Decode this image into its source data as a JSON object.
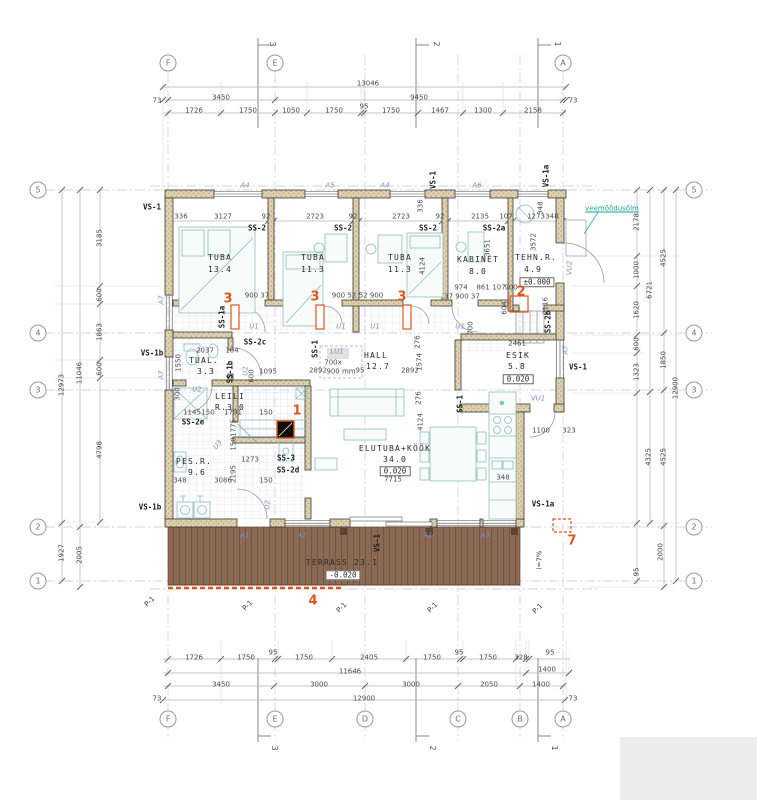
{
  "drawing": {
    "type": "floor-plan",
    "rooms": [
      {
        "name": "TUBA",
        "area_m2": "13.4"
      },
      {
        "name": "TUBA",
        "area_m2": "11.3"
      },
      {
        "name": "TUBA",
        "area_m2": "11.3"
      },
      {
        "name": "KABINET",
        "area_m2": "8.0"
      },
      {
        "name": "TEHN.R.",
        "area_m2": "4.9",
        "level": "±0.000"
      },
      {
        "name": "TUAL.",
        "area_m2": "3.3"
      },
      {
        "name": "HALL",
        "area_m2": "12.7"
      },
      {
        "name": "ESIK",
        "area_m2": "5.8",
        "level": "0.020"
      },
      {
        "name": "LEILI R.",
        "area_m2": "3.0"
      },
      {
        "name": "PES.R.",
        "area_m2": "9.6"
      },
      {
        "name": "ELUTUBA+KÖÖK",
        "area_m2": "34.0",
        "level": "0.020"
      },
      {
        "name": "TERRASS",
        "area_m2": "23.1",
        "level": "-0.020"
      }
    ],
    "colors": {
      "marker_orange": "#e0551c",
      "terrace_brown": "#8b6a55",
      "wall_fill": "#ded0ae",
      "blue_label": "#7d8fc4",
      "teal_note": "#17a2a2"
    }
  },
  "grid": {
    "letters_top": [
      "F",
      "E",
      "A"
    ],
    "letters_bottom": [
      "F",
      "E",
      "D",
      "C",
      "B",
      "A"
    ],
    "numbers_left": [
      "5",
      "4",
      "3",
      "2",
      "1"
    ],
    "numbers_right": [
      "5",
      "4",
      "3",
      "2",
      "1"
    ],
    "circles": [
      {
        "t": "F",
        "x": 168,
        "y": 63
      },
      {
        "t": "E",
        "x": 275,
        "y": 63
      },
      {
        "t": "A",
        "x": 563,
        "y": 63
      },
      {
        "t": "F",
        "x": 168,
        "y": 719
      },
      {
        "t": "E",
        "x": 275,
        "y": 719
      },
      {
        "t": "D",
        "x": 365,
        "y": 719
      },
      {
        "t": "C",
        "x": 458,
        "y": 719
      },
      {
        "t": "B",
        "x": 520,
        "y": 719
      },
      {
        "t": "A",
        "x": 563,
        "y": 719
      },
      {
        "t": "5",
        "x": 38,
        "y": 190
      },
      {
        "t": "4",
        "x": 38,
        "y": 333
      },
      {
        "t": "3",
        "x": 38,
        "y": 390
      },
      {
        "t": "2",
        "x": 38,
        "y": 527
      },
      {
        "t": "1",
        "x": 38,
        "y": 581
      },
      {
        "t": "5",
        "x": 694,
        "y": 190
      },
      {
        "t": "4",
        "x": 694,
        "y": 333
      },
      {
        "t": "3",
        "x": 694,
        "y": 390
      },
      {
        "t": "2",
        "x": 694,
        "y": 527
      },
      {
        "t": "1",
        "x": 694,
        "y": 581
      }
    ]
  },
  "texts": [
    {
      "t": "13046",
      "x": 368,
      "y": 84
    },
    {
      "t": "73",
      "x": 157,
      "y": 101
    },
    {
      "t": "3450",
      "x": 221,
      "y": 98
    },
    {
      "t": "9450",
      "x": 419,
      "y": 98
    },
    {
      "t": "73",
      "x": 573,
      "y": 101
    },
    {
      "t": "1726",
      "x": 194,
      "y": 111
    },
    {
      "t": "1750",
      "x": 248,
      "y": 111
    },
    {
      "t": "1050",
      "x": 291,
      "y": 111
    },
    {
      "t": "1750",
      "x": 334,
      "y": 111
    },
    {
      "t": "95",
      "x": 364,
      "y": 107
    },
    {
      "t": "1750",
      "x": 391,
      "y": 111
    },
    {
      "t": "1467",
      "x": 440,
      "y": 111
    },
    {
      "t": "1300",
      "x": 483,
      "y": 111
    },
    {
      "t": "2158",
      "x": 533,
      "y": 111
    },
    {
      "t": "1726",
      "x": 194,
      "y": 658
    },
    {
      "t": "1750",
      "x": 246,
      "y": 658
    },
    {
      "t": "95",
      "x": 273,
      "y": 653
    },
    {
      "t": "1750",
      "x": 304,
      "y": 658
    },
    {
      "t": "2405",
      "x": 369,
      "y": 658
    },
    {
      "t": "1750",
      "x": 432,
      "y": 658
    },
    {
      "t": "95",
      "x": 459,
      "y": 653
    },
    {
      "t": "1750",
      "x": 488,
      "y": 658
    },
    {
      "t": "328",
      "x": 521,
      "y": 658
    },
    {
      "t": "95",
      "x": 550,
      "y": 653
    },
    {
      "t": "11646",
      "x": 350,
      "y": 672
    },
    {
      "t": "1400",
      "x": 547,
      "y": 670
    },
    {
      "t": "3450",
      "x": 221,
      "y": 685
    },
    {
      "t": "3000",
      "x": 319,
      "y": 685
    },
    {
      "t": "3000",
      "x": 411,
      "y": 685
    },
    {
      "t": "2050",
      "x": 489,
      "y": 685
    },
    {
      "t": "1400",
      "x": 541,
      "y": 685
    },
    {
      "t": "73",
      "x": 157,
      "y": 699
    },
    {
      "t": "12900",
      "x": 364,
      "y": 699
    },
    {
      "t": "73",
      "x": 573,
      "y": 699
    },
    {
      "t": "12973",
      "x": 62,
      "y": 385,
      "r": -90
    },
    {
      "t": "1927",
      "x": 62,
      "y": 553,
      "r": -90
    },
    {
      "t": "11046",
      "x": 80,
      "y": 373,
      "r": -90
    },
    {
      "t": "2005",
      "x": 80,
      "y": 555,
      "r": -90
    },
    {
      "t": "3185",
      "x": 100,
      "y": 238,
      "r": -90
    },
    {
      "t": "600",
      "x": 100,
      "y": 295,
      "r": -90
    },
    {
      "t": "1863",
      "x": 100,
      "y": 332,
      "r": -90
    },
    {
      "t": "600",
      "x": 100,
      "y": 369,
      "r": -90
    },
    {
      "t": "4798",
      "x": 100,
      "y": 450,
      "r": -90
    },
    {
      "t": "2178",
      "x": 637,
      "y": 222,
      "r": -90
    },
    {
      "t": "1000",
      "x": 637,
      "y": 270,
      "r": -90
    },
    {
      "t": "1620",
      "x": 637,
      "y": 310,
      "r": -90
    },
    {
      "t": "600",
      "x": 637,
      "y": 344,
      "r": -90
    },
    {
      "t": "1323",
      "x": 637,
      "y": 372,
      "r": -90
    },
    {
      "t": "95",
      "x": 637,
      "y": 572,
      "r": -90
    },
    {
      "t": "6721",
      "x": 650,
      "y": 290,
      "r": -90
    },
    {
      "t": "4325",
      "x": 649,
      "y": 457,
      "r": -90
    },
    {
      "t": "4525",
      "x": 664,
      "y": 258,
      "r": -90
    },
    {
      "t": "1850",
      "x": 664,
      "y": 360,
      "r": -90
    },
    {
      "t": "4525",
      "x": 664,
      "y": 457,
      "r": -90
    },
    {
      "t": "2000",
      "x": 661,
      "y": 552,
      "r": -90
    },
    {
      "t": "12900",
      "x": 676,
      "y": 388,
      "r": -90
    },
    {
      "t": "336",
      "x": 181,
      "y": 217
    },
    {
      "t": "3127",
      "x": 223,
      "y": 217
    },
    {
      "t": "92",
      "x": 266,
      "y": 217
    },
    {
      "t": "2723",
      "x": 315,
      "y": 217
    },
    {
      "t": "92",
      "x": 353,
      "y": 217
    },
    {
      "t": "2723",
      "x": 401,
      "y": 217
    },
    {
      "t": "92",
      "x": 440,
      "y": 217
    },
    {
      "t": "2135",
      "x": 480,
      "y": 217
    },
    {
      "t": "107",
      "x": 506,
      "y": 217
    },
    {
      "t": "1273",
      "x": 536,
      "y": 217
    },
    {
      "t": "348",
      "x": 552,
      "y": 217
    },
    {
      "t": "336",
      "x": 421,
      "y": 206,
      "r": -90
    },
    {
      "t": "348",
      "x": 541,
      "y": 208,
      "r": -90
    },
    {
      "t": "3651",
      "x": 488,
      "y": 248,
      "r": -90
    },
    {
      "t": "3572",
      "x": 534,
      "y": 242,
      "r": -90
    },
    {
      "t": "4124",
      "x": 423,
      "y": 266,
      "r": -90
    },
    {
      "t": "900 37",
      "x": 257,
      "y": 296
    },
    {
      "t": "900 52",
      "x": 344,
      "y": 296
    },
    {
      "t": "52 900",
      "x": 371,
      "y": 296
    },
    {
      "t": "974",
      "x": 461,
      "y": 288
    },
    {
      "t": "861",
      "x": 483,
      "y": 288
    },
    {
      "t": "107",
      "x": 499,
      "y": 288
    },
    {
      "t": "900",
      "x": 511,
      "y": 288
    },
    {
      "t": "37 900 37",
      "x": 462,
      "y": 297
    },
    {
      "t": "700",
      "x": 471,
      "y": 328,
      "r": -90
    },
    {
      "t": "604",
      "x": 505,
      "y": 308,
      "r": -90
    },
    {
      "t": "2116",
      "x": 546,
      "y": 306,
      "r": -90
    },
    {
      "t": "2037",
      "x": 205,
      "y": 351
    },
    {
      "t": "104",
      "x": 232,
      "y": 351
    },
    {
      "t": "1550",
      "x": 179,
      "y": 363,
      "r": -90
    },
    {
      "t": "600",
      "x": 252,
      "y": 376,
      "r": -90
    },
    {
      "t": "1095",
      "x": 268,
      "y": 372
    },
    {
      "t": "2892",
      "x": 318,
      "y": 371
    },
    {
      "t": "95",
      "x": 360,
      "y": 371
    },
    {
      "t": "2892",
      "x": 410,
      "y": 371
    },
    {
      "t": "2461",
      "x": 517,
      "y": 344
    },
    {
      "t": "276",
      "x": 418,
      "y": 342,
      "r": -90
    },
    {
      "t": "1574",
      "x": 420,
      "y": 362,
      "r": -90
    },
    {
      "t": "276",
      "x": 419,
      "y": 398,
      "r": -90
    },
    {
      "t": "4124",
      "x": 421,
      "y": 422,
      "r": -90
    },
    {
      "t": "1100",
      "x": 541,
      "y": 431
    },
    {
      "t": "323",
      "x": 569,
      "y": 431
    },
    {
      "t": "300",
      "x": 178,
      "y": 394,
      "r": -90
    },
    {
      "t": "1145",
      "x": 192,
      "y": 413
    },
    {
      "t": "150",
      "x": 208,
      "y": 413
    },
    {
      "t": "1791",
      "x": 233,
      "y": 413
    },
    {
      "t": "150",
      "x": 266,
      "y": 413
    },
    {
      "t": "1775",
      "x": 234,
      "y": 428,
      "r": -90
    },
    {
      "t": "150",
      "x": 234,
      "y": 444,
      "r": -90
    },
    {
      "t": "1273",
      "x": 250,
      "y": 460
    },
    {
      "t": "348",
      "x": 180,
      "y": 481
    },
    {
      "t": "3086",
      "x": 223,
      "y": 481
    },
    {
      "t": "2195",
      "x": 234,
      "y": 474,
      "r": -90
    },
    {
      "t": "150",
      "x": 266,
      "y": 481
    },
    {
      "t": "7715",
      "x": 393,
      "y": 480
    },
    {
      "t": "348",
      "x": 503,
      "y": 478
    },
    {
      "t": "i=7%",
      "x": 540,
      "y": 560,
      "r": -90
    },
    {
      "t": "TUBA",
      "x": 220,
      "y": 258,
      "c": "rm",
      "n": "room-label-tuba-1"
    },
    {
      "t": "13.4",
      "x": 220,
      "y": 270,
      "c": "rm",
      "n": "room-area-tuba-1"
    },
    {
      "t": "TUBA",
      "x": 313,
      "y": 258,
      "c": "rm",
      "n": "room-label-tuba-2"
    },
    {
      "t": "11.3",
      "x": 313,
      "y": 270,
      "c": "rm",
      "n": "room-area-tuba-2"
    },
    {
      "t": "TUBA",
      "x": 400,
      "y": 258,
      "c": "rm",
      "n": "room-label-tuba-3"
    },
    {
      "t": "11.3",
      "x": 400,
      "y": 270,
      "c": "rm",
      "n": "room-area-tuba-3"
    },
    {
      "t": "KABINET",
      "x": 478,
      "y": 260,
      "c": "rm",
      "n": "room-label-kabinet"
    },
    {
      "t": "8.0",
      "x": 478,
      "y": 272,
      "c": "rm",
      "n": "room-area-kabinet"
    },
    {
      "t": "TEHN.R.",
      "x": 536,
      "y": 258,
      "c": "rm",
      "n": "room-label-tehnr"
    },
    {
      "t": "4.9",
      "x": 533,
      "y": 270,
      "c": "rm",
      "n": "room-area-tehnr"
    },
    {
      "t": "±0.000",
      "x": 537,
      "y": 282,
      "c": "lv",
      "n": "level-tehnr"
    },
    {
      "t": "TUAL.",
      "x": 204,
      "y": 361,
      "c": "rm",
      "n": "room-label-tual"
    },
    {
      "t": "3.3",
      "x": 206,
      "y": 372,
      "c": "rm",
      "n": "room-area-tual"
    },
    {
      "t": "HALL",
      "x": 376,
      "y": 356,
      "c": "rm",
      "n": "room-label-hall"
    },
    {
      "t": "12.7",
      "x": 378,
      "y": 367,
      "c": "rm",
      "n": "room-area-hall"
    },
    {
      "t": "ESIK",
      "x": 518,
      "y": 356,
      "c": "rm",
      "n": "room-label-esik"
    },
    {
      "t": "5.8",
      "x": 517,
      "y": 367,
      "c": "rm",
      "n": "room-area-esik"
    },
    {
      "t": "0.020",
      "x": 518,
      "y": 379,
      "c": "lv",
      "n": "level-esik"
    },
    {
      "t": "LEILI",
      "x": 230,
      "y": 397,
      "c": "rm",
      "n": "room-label-leili"
    },
    {
      "t": "R.3.0",
      "x": 230,
      "y": 408,
      "c": "rm",
      "n": "room-area-leili"
    },
    {
      "t": "PES.R.",
      "x": 194,
      "y": 462,
      "c": "rm",
      "n": "room-label-pesr"
    },
    {
      "t": "9.6",
      "x": 197,
      "y": 473,
      "c": "rm",
      "n": "room-area-pesr"
    },
    {
      "t": "ELUTUBA+KÖÖK",
      "x": 395,
      "y": 449,
      "c": "rm",
      "n": "room-label-elutuba-kook"
    },
    {
      "t": "34.0",
      "x": 395,
      "y": 460,
      "c": "rm",
      "n": "room-area-elutuba"
    },
    {
      "t": "0.020",
      "x": 395,
      "y": 471,
      "c": "lv",
      "n": "level-elutuba"
    },
    {
      "t": "TERRASS 23.1",
      "x": 342,
      "y": 563,
      "c": "rm",
      "n": "room-label-terrass"
    },
    {
      "t": "-0.020",
      "x": 343,
      "y": 575,
      "c": "lv",
      "n": "level-terrass"
    },
    {
      "t": "LU1",
      "x": 337,
      "y": 352,
      "c": "bl",
      "n": "skylight-label"
    },
    {
      "t": "700x",
      "x": 333,
      "y": 363
    },
    {
      "t": "900 mm",
      "x": 341,
      "y": 372
    },
    {
      "t": "VS-1",
      "x": 152,
      "y": 207,
      "c": "wl"
    },
    {
      "t": "VS-1",
      "x": 433,
      "y": 180,
      "c": "wl",
      "r": -90
    },
    {
      "t": "VS-1a",
      "x": 546,
      "y": 176,
      "c": "wl",
      "r": -90
    },
    {
      "t": "SS-2",
      "x": 257,
      "y": 228,
      "c": "wl"
    },
    {
      "t": "SS-2",
      "x": 343,
      "y": 228,
      "c": "wl"
    },
    {
      "t": "SS-2",
      "x": 428,
      "y": 228,
      "c": "wl"
    },
    {
      "t": "SS-2a",
      "x": 494,
      "y": 228,
      "c": "wl"
    },
    {
      "t": "SS-1a",
      "x": 222,
      "y": 317,
      "c": "wl",
      "r": -90
    },
    {
      "t": "SS-2c",
      "x": 255,
      "y": 342,
      "c": "wl"
    },
    {
      "t": "SS-1b",
      "x": 230,
      "y": 372,
      "c": "wl",
      "r": -90
    },
    {
      "t": "SS-1",
      "x": 315,
      "y": 349,
      "c": "wl",
      "r": -90
    },
    {
      "t": "SS-2e",
      "x": 193,
      "y": 422,
      "c": "wl"
    },
    {
      "t": "SS-3",
      "x": 286,
      "y": 458,
      "c": "wl"
    },
    {
      "t": "SS-2d",
      "x": 288,
      "y": 470,
      "c": "wl"
    },
    {
      "t": "SS-1",
      "x": 460,
      "y": 404,
      "c": "wl",
      "r": -90
    },
    {
      "t": "SS-2b",
      "x": 548,
      "y": 322,
      "c": "wl",
      "r": -90
    },
    {
      "t": "VS-1",
      "x": 578,
      "y": 367,
      "c": "wl"
    },
    {
      "t": "VS-1b",
      "x": 152,
      "y": 353,
      "c": "wl"
    },
    {
      "t": "VS-1b",
      "x": 150,
      "y": 507,
      "c": "wl"
    },
    {
      "t": "VS-1a",
      "x": 543,
      "y": 504,
      "c": "wl"
    },
    {
      "t": "VS-1",
      "x": 377,
      "y": 543,
      "c": "wl",
      "r": -90
    },
    {
      "t": "A4",
      "x": 245,
      "y": 186,
      "c": "bl"
    },
    {
      "t": "A5",
      "x": 330,
      "y": 186,
      "c": "bl"
    },
    {
      "t": "A4",
      "x": 385,
      "y": 186,
      "c": "bl"
    },
    {
      "t": "A6",
      "x": 477,
      "y": 186,
      "c": "bl"
    },
    {
      "t": "A7",
      "x": 162,
      "y": 300,
      "c": "bl",
      "r": -90
    },
    {
      "t": "A7",
      "x": 162,
      "y": 375,
      "c": "bl",
      "r": -90
    },
    {
      "t": "A7",
      "x": 566,
      "y": 350,
      "c": "bl",
      "r": -90
    },
    {
      "t": "VU2",
      "x": 570,
      "y": 268,
      "c": "bl",
      "r": -90
    },
    {
      "t": "VU1",
      "x": 538,
      "y": 399,
      "c": "bl"
    },
    {
      "t": "U1",
      "x": 254,
      "y": 327,
      "c": "bl"
    },
    {
      "t": "U1",
      "x": 341,
      "y": 327,
      "c": "bl"
    },
    {
      "t": "U1",
      "x": 375,
      "y": 327,
      "c": "bl"
    },
    {
      "t": "U1",
      "x": 460,
      "y": 327,
      "c": "bl"
    },
    {
      "t": "U2",
      "x": 246,
      "y": 371,
      "c": "bl",
      "r": -90
    },
    {
      "t": "U2",
      "x": 197,
      "y": 390,
      "c": "bl"
    },
    {
      "t": "U3",
      "x": 218,
      "y": 445,
      "c": "bl",
      "r": -50
    },
    {
      "t": "U2",
      "x": 268,
      "y": 505,
      "c": "bl",
      "r": -90
    },
    {
      "t": "A1",
      "x": 245,
      "y": 536,
      "c": "bl"
    },
    {
      "t": "A2",
      "x": 302,
      "y": 536,
      "c": "bl"
    },
    {
      "t": "A1",
      "x": 428,
      "y": 536,
      "c": "bl"
    },
    {
      "t": "A3",
      "x": 485,
      "y": 536,
      "c": "bl"
    },
    {
      "t": "3",
      "x": 228,
      "y": 299,
      "c": "or",
      "n": "marker-3a"
    },
    {
      "t": "3",
      "x": 315,
      "y": 297,
      "c": "or",
      "n": "marker-3b"
    },
    {
      "t": "3",
      "x": 402,
      "y": 297,
      "c": "or",
      "n": "marker-3c"
    },
    {
      "t": "1",
      "x": 297,
      "y": 411,
      "c": "or",
      "n": "marker-1"
    },
    {
      "t": "2",
      "x": 521,
      "y": 292,
      "c": "or",
      "n": "marker-2"
    },
    {
      "t": "4",
      "x": 313,
      "y": 601,
      "c": "or",
      "n": "marker-4"
    },
    {
      "t": "7",
      "x": 572,
      "y": 541,
      "c": "or",
      "n": "marker-7"
    },
    {
      "t": "veemõõdusõlm",
      "x": 612,
      "y": 209,
      "c": "tl u",
      "n": "water-meter-note"
    },
    {
      "t": "❄",
      "x": 502,
      "y": 404,
      "c": "tl",
      "n": "fridge-icon"
    },
    {
      "t": "P-1",
      "x": 150,
      "y": 602,
      "r": -45,
      "c": "p1"
    },
    {
      "t": "P-1",
      "x": 248,
      "y": 606,
      "r": -45,
      "c": "p1"
    },
    {
      "t": "P-1",
      "x": 342,
      "y": 608,
      "r": -45,
      "c": "p1"
    },
    {
      "t": "P-1",
      "x": 433,
      "y": 608,
      "r": -45,
      "c": "p1"
    },
    {
      "t": "P-1",
      "x": 538,
      "y": 609,
      "r": -45,
      "c": "p1"
    },
    {
      "t": "3",
      "x": 272,
      "y": 44,
      "r": 90,
      "c": "sec",
      "n": "section-mark-3"
    },
    {
      "t": "2",
      "x": 436,
      "y": 44,
      "r": 90,
      "c": "sec",
      "n": "section-mark-2"
    },
    {
      "t": "1",
      "x": 557,
      "y": 44,
      "r": 90,
      "c": "sec",
      "n": "section-mark-1"
    },
    {
      "t": "3",
      "x": 274,
      "y": 748,
      "r": 90,
      "c": "sec"
    },
    {
      "t": "2",
      "x": 432,
      "y": 748,
      "r": 90,
      "c": "sec"
    },
    {
      "t": "1",
      "x": 554,
      "y": 748,
      "r": 90,
      "c": "sec"
    }
  ]
}
